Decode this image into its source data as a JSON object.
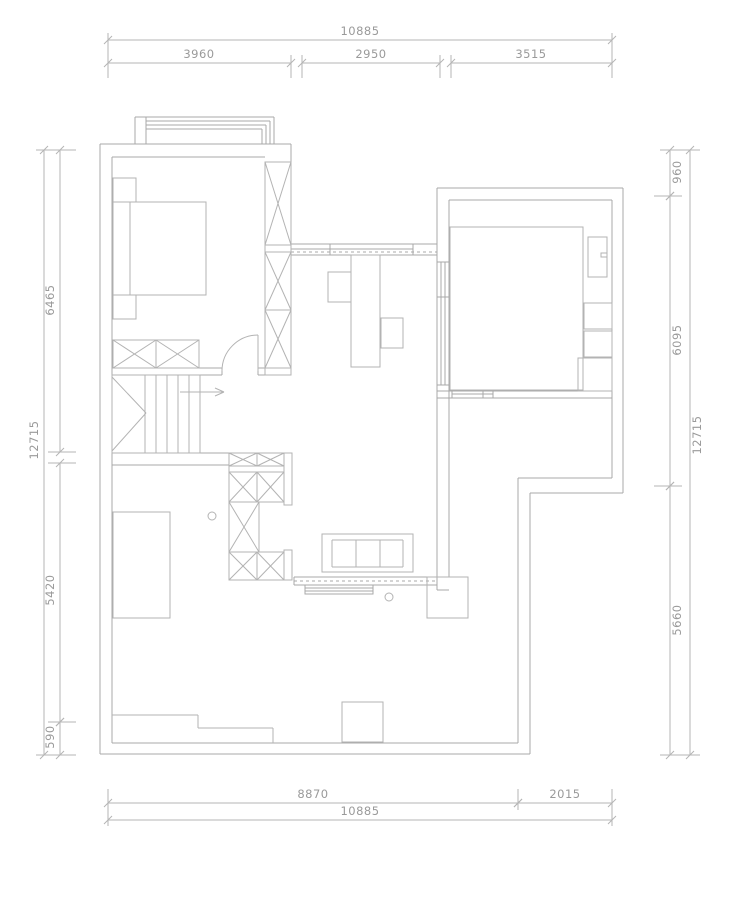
{
  "title": "floor-plan-drawing",
  "colors": {
    "wall": "#a9a9a9",
    "furniture": "#b3b3b3",
    "dim_line": "#b5b5b5",
    "dim_text": "#9a9a9a",
    "background": "#ffffff"
  },
  "canvas": {
    "width": 740,
    "height": 905
  },
  "plan": {
    "groups": [
      {
        "name": "walls",
        "stroke": "wall",
        "lines": [
          [
            100,
            144,
            100,
            754
          ],
          [
            112,
            157,
            112,
            743
          ],
          [
            100,
            144,
            291,
            144
          ],
          [
            112,
            157,
            265,
            157
          ],
          [
            291,
            144,
            291,
            375
          ],
          [
            112,
            368,
            222,
            368
          ],
          [
            112,
            375,
            222,
            375
          ],
          [
            258,
            368,
            291,
            368
          ],
          [
            258,
            375,
            291,
            375
          ],
          [
            222,
            368,
            222,
            375
          ],
          [
            258,
            368,
            258,
            375
          ],
          [
            437,
            188,
            437,
            590
          ],
          [
            449,
            200,
            449,
            577
          ],
          [
            437,
            590,
            449,
            590
          ],
          [
            437,
            188,
            623,
            188
          ],
          [
            449,
            200,
            612,
            200
          ],
          [
            623,
            188,
            623,
            493
          ],
          [
            612,
            200,
            612,
            478
          ],
          [
            437,
            391,
            612,
            391
          ],
          [
            437,
            398,
            612,
            398
          ],
          [
            518,
            478,
            612,
            478
          ],
          [
            530,
            493,
            623,
            493
          ],
          [
            518,
            478,
            518,
            743
          ],
          [
            530,
            493,
            530,
            754
          ],
          [
            112,
            743,
            518,
            743
          ],
          [
            100,
            754,
            530,
            754
          ],
          [
            112,
            453,
            229,
            453
          ],
          [
            112,
            465,
            229,
            465
          ]
        ]
      },
      {
        "name": "bay-window",
        "stroke": "wall",
        "lines": [
          [
            135,
            117,
            135,
            144
          ],
          [
            146,
            117,
            146,
            144
          ],
          [
            135,
            117,
            274,
            117
          ],
          [
            146,
            121,
            270,
            121
          ],
          [
            146,
            125,
            266,
            125
          ],
          [
            146,
            129,
            262,
            129
          ],
          [
            274,
            117,
            274,
            144
          ],
          [
            270,
            121,
            270,
            144
          ],
          [
            266,
            125,
            266,
            144
          ],
          [
            262,
            129,
            262,
            144
          ]
        ]
      },
      {
        "name": "hall-top-window",
        "stroke": "wall",
        "lines": [
          [
            291,
            244,
            437,
            244
          ],
          [
            291,
            249,
            413,
            249
          ],
          [
            291,
            255,
            437,
            255
          ],
          [
            330,
            244,
            330,
            255
          ],
          [
            413,
            244,
            413,
            255
          ]
        ],
        "dashed": [
          [
            291,
            252,
            437,
            252
          ]
        ]
      },
      {
        "name": "room-left-window",
        "stroke": "wall",
        "lines": [
          [
            441,
            262,
            441,
            385
          ],
          [
            445,
            262,
            445,
            385
          ],
          [
            437,
            262,
            449,
            262
          ],
          [
            437,
            297,
            449,
            297
          ],
          [
            437,
            385,
            449,
            385
          ]
        ]
      },
      {
        "name": "room-bottom-window",
        "stroke": "wall",
        "lines": [
          [
            452,
            391,
            452,
            398
          ],
          [
            483,
            391,
            483,
            398
          ],
          [
            493,
            391,
            493,
            398
          ],
          [
            452,
            394,
            493,
            394
          ]
        ]
      },
      {
        "name": "terrace-window",
        "stroke": "wall",
        "lines": [
          [
            294,
            577,
            437,
            577
          ],
          [
            294,
            585,
            437,
            585
          ],
          [
            294,
            577,
            294,
            585
          ],
          [
            305,
            588,
            373,
            588
          ],
          [
            305,
            591,
            373,
            591
          ]
        ],
        "dashed": [
          [
            294,
            581,
            437,
            581
          ]
        ],
        "rects": [
          [
            305,
            585,
            68,
            9
          ]
        ]
      },
      {
        "name": "bedroom-door",
        "stroke": "furniture",
        "lines": [
          [
            258,
            335,
            258,
            371
          ]
        ],
        "paths": [
          "M 258 335 A 36 36 0 0 0 222 371"
        ]
      },
      {
        "name": "bed",
        "stroke": "furniture",
        "rects": [
          [
            113,
            202,
            93,
            93
          ]
        ],
        "lines": [
          [
            130,
            202,
            130,
            295
          ]
        ]
      },
      {
        "name": "nightstands",
        "stroke": "furniture",
        "rects": [
          [
            113,
            178,
            23,
            24
          ],
          [
            113,
            295,
            23,
            24
          ]
        ]
      },
      {
        "name": "wardrobe-right",
        "stroke": "furniture",
        "xrects": [
          [
            265,
            162,
            26,
            83
          ],
          [
            265,
            252,
            26,
            58
          ],
          [
            265,
            310,
            26,
            58
          ]
        ],
        "rects": [
          [
            265,
            245,
            26,
            7
          ],
          [
            265,
            368,
            26,
            7
          ]
        ]
      },
      {
        "name": "wardrobe-bottom",
        "stroke": "furniture",
        "xrects": [
          [
            113,
            340,
            43,
            28
          ],
          [
            156,
            340,
            43,
            28
          ]
        ]
      },
      {
        "name": "stairs",
        "stroke": "furniture",
        "rects": [
          [
            112,
            375,
            88,
            78
          ]
        ],
        "lines": [
          [
            145,
            375,
            145,
            453
          ],
          [
            156,
            375,
            156,
            453
          ],
          [
            167,
            375,
            167,
            453
          ],
          [
            178,
            375,
            178,
            453
          ],
          [
            189,
            375,
            189,
            453
          ],
          [
            112,
            377,
            146,
            413
          ],
          [
            112,
            451,
            146,
            413
          ],
          [
            180,
            392,
            224,
            392
          ],
          [
            224,
            392,
            215,
            388
          ],
          [
            224,
            392,
            215,
            396
          ]
        ]
      },
      {
        "name": "storage-cabinet",
        "stroke": "furniture",
        "xrects": [
          [
            229,
            453,
            28,
            13
          ],
          [
            257,
            453,
            27,
            13
          ],
          [
            229,
            472,
            28,
            30
          ],
          [
            257,
            472,
            27,
            30
          ],
          [
            229,
            502,
            30,
            50
          ],
          [
            229,
            552,
            28,
            28
          ],
          [
            257,
            552,
            27,
            28
          ]
        ],
        "rects": [
          [
            229,
            466,
            55,
            6
          ],
          [
            284,
            453,
            8,
            52
          ],
          [
            284,
            550,
            8,
            30
          ]
        ]
      },
      {
        "name": "desk-area",
        "stroke": "furniture",
        "rects": [
          [
            351,
            255,
            29,
            112
          ],
          [
            328,
            272,
            23,
            30
          ],
          [
            381,
            318,
            22,
            30
          ]
        ]
      },
      {
        "name": "sofa",
        "stroke": "furniture",
        "rects": [
          [
            322,
            534,
            91,
            38
          ]
        ],
        "lines": [
          [
            332,
            540,
            403,
            540
          ],
          [
            332,
            540,
            332,
            567
          ],
          [
            403,
            540,
            403,
            567
          ],
          [
            356,
            540,
            356,
            567
          ],
          [
            380,
            540,
            380,
            567
          ],
          [
            332,
            567,
            403,
            567
          ]
        ]
      },
      {
        "name": "platform-room",
        "stroke": "furniture",
        "rects": [
          [
            450,
            227,
            133,
            163
          ],
          [
            588,
            237,
            19,
            40
          ],
          [
            601,
            253,
            6,
            4
          ],
          [
            584,
            303,
            28,
            26
          ],
          [
            584,
            331,
            28,
            26
          ],
          [
            578,
            358,
            34,
            33
          ]
        ]
      },
      {
        "name": "planters",
        "stroke": "furniture",
        "rects": [
          [
            113,
            512,
            57,
            106
          ],
          [
            427,
            577,
            41,
            41
          ],
          [
            342,
            702,
            41,
            40
          ]
        ]
      },
      {
        "name": "fixtures",
        "stroke": "furniture",
        "circles": [
          [
            212,
            516,
            4
          ],
          [
            389,
            597,
            4
          ]
        ]
      },
      {
        "name": "terrace-steps",
        "stroke": "furniture",
        "lines": [
          [
            112,
            715,
            198,
            715
          ],
          [
            198,
            715,
            198,
            728
          ],
          [
            198,
            728,
            273,
            728
          ],
          [
            273,
            728,
            273,
            743
          ]
        ]
      }
    ],
    "dims": {
      "items": [
        {
          "name": "dim-top-overall",
          "o": "h",
          "y": 40,
          "x1": 108,
          "x2": 612,
          "label": "10885",
          "lx": 360,
          "ly": 35
        },
        {
          "name": "dim-top-seg1",
          "o": "h",
          "y": 63,
          "x1": 108,
          "x2": 291,
          "label": "3960",
          "lx": 199,
          "ly": 58
        },
        {
          "name": "dim-top-seg2",
          "o": "h",
          "y": 63,
          "x1": 302,
          "x2": 440,
          "label": "2950",
          "lx": 371,
          "ly": 58
        },
        {
          "name": "dim-top-seg3",
          "o": "h",
          "y": 63,
          "x1": 451,
          "x2": 612,
          "label": "3515",
          "lx": 531,
          "ly": 58
        },
        {
          "name": "dim-bottom-seg1",
          "o": "h",
          "y": 803,
          "x1": 108,
          "x2": 518,
          "label": "8870",
          "lx": 313,
          "ly": 798
        },
        {
          "name": "dim-bottom-seg2",
          "o": "h",
          "y": 803,
          "x1": 518,
          "x2": 612,
          "label": "2015",
          "lx": 565,
          "ly": 798
        },
        {
          "name": "dim-bottom-overall",
          "o": "h",
          "y": 820,
          "x1": 108,
          "x2": 612,
          "label": "10885",
          "lx": 360,
          "ly": 815
        },
        {
          "name": "dim-left-seg1",
          "o": "v",
          "x": 60,
          "y1": 150,
          "y2": 452,
          "label": "6465",
          "lx": 54,
          "ly": 300
        },
        {
          "name": "dim-left-seg2",
          "o": "v",
          "x": 60,
          "y1": 463,
          "y2": 722,
          "label": "5420",
          "lx": 54,
          "ly": 590
        },
        {
          "name": "dim-left-seg3",
          "o": "v",
          "x": 60,
          "y1": 722,
          "y2": 755,
          "label": "590",
          "lx": 54,
          "ly": 737
        },
        {
          "name": "dim-left-overall",
          "o": "v",
          "x": 44,
          "y1": 150,
          "y2": 755,
          "label": "12715",
          "lx": 38,
          "ly": 440
        },
        {
          "name": "dim-right-seg1",
          "o": "v",
          "x": 670,
          "y1": 150,
          "y2": 196,
          "label": "960",
          "lx": 681,
          "ly": 172
        },
        {
          "name": "dim-right-seg2",
          "o": "v",
          "x": 670,
          "y1": 196,
          "y2": 486,
          "label": "6095",
          "lx": 681,
          "ly": 340
        },
        {
          "name": "dim-right-seg3",
          "o": "v",
          "x": 670,
          "y1": 486,
          "y2": 755,
          "label": "5660",
          "lx": 681,
          "ly": 620
        },
        {
          "name": "dim-right-overall",
          "o": "v",
          "x": 690,
          "y1": 150,
          "y2": 755,
          "label": "12715",
          "lx": 701,
          "ly": 435
        }
      ],
      "extensions": [
        [
          108,
          33,
          108,
          78
        ],
        [
          291,
          55,
          291,
          78
        ],
        [
          302,
          55,
          302,
          78
        ],
        [
          440,
          55,
          440,
          78
        ],
        [
          451,
          55,
          451,
          78
        ],
        [
          612,
          33,
          612,
          78
        ],
        [
          108,
          789,
          108,
          826
        ],
        [
          518,
          789,
          518,
          810
        ],
        [
          612,
          789,
          612,
          826
        ],
        [
          36,
          150,
          76,
          150
        ],
        [
          48,
          452,
          76,
          452
        ],
        [
          48,
          463,
          76,
          463
        ],
        [
          48,
          722,
          76,
          722
        ],
        [
          36,
          755,
          76,
          755
        ],
        [
          660,
          150,
          700,
          150
        ],
        [
          654,
          196,
          682,
          196
        ],
        [
          654,
          486,
          682,
          486
        ],
        [
          660,
          755,
          700,
          755
        ]
      ]
    }
  }
}
